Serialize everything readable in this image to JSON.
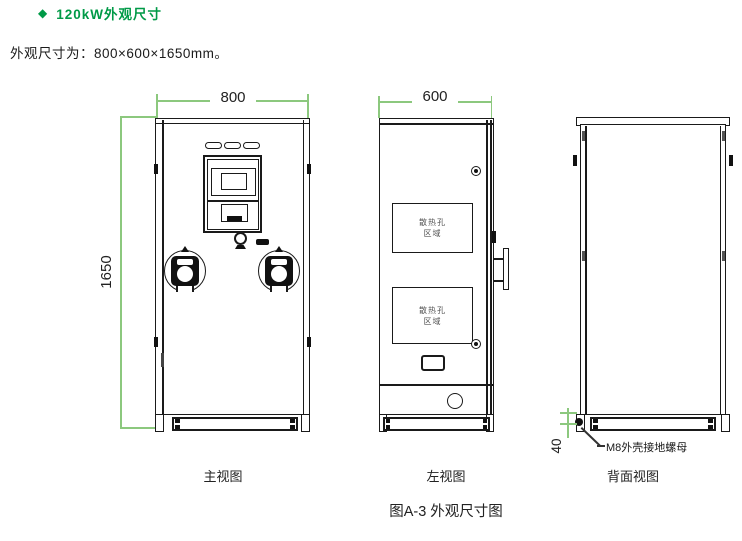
{
  "page": {
    "title_bullet": "◆",
    "title": "120kW外观尺寸",
    "subtitle": "外观尺寸为：800×600×1650mm。",
    "figure_caption": "图A-3 外观尺寸图"
  },
  "colors": {
    "accent_green": "#009a47",
    "dimension_green": "#8cc87e",
    "line_black": "#1a1a1a"
  },
  "front_view": {
    "caption": "主视图",
    "width_dim": "800",
    "height_dim": "1650"
  },
  "left_view": {
    "caption": "左视图",
    "width_dim": "600",
    "vent_label_line1": "散热孔",
    "vent_label_line2": "区域"
  },
  "back_view": {
    "caption": "背面视图",
    "ground_height_dim": "40",
    "ground_nut_label": "M8外壳接地螺母"
  }
}
